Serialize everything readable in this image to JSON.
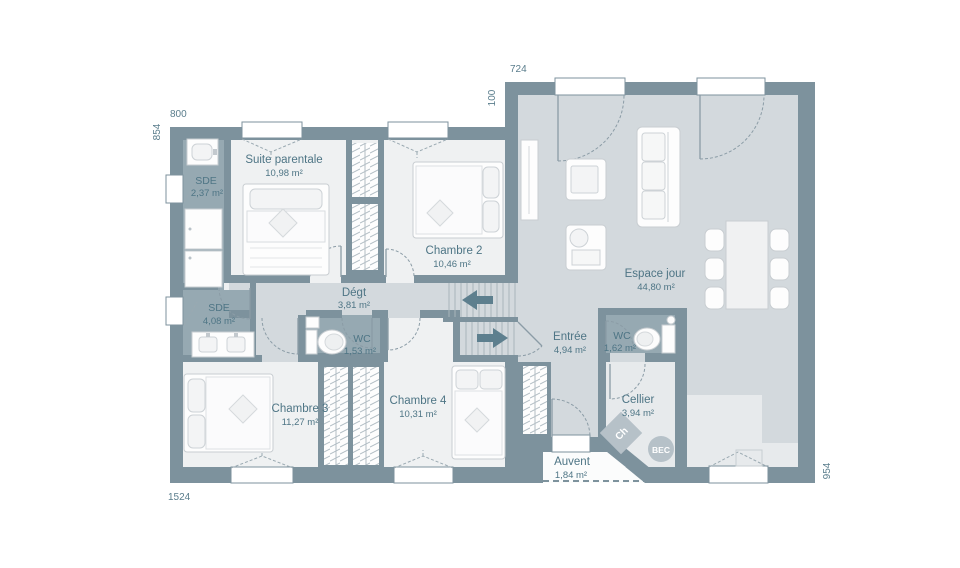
{
  "plan": {
    "dimensions": {
      "top_left": "800",
      "left_side": "854",
      "top_right": "724",
      "offset": "100",
      "bottom_left": "1524",
      "right_side": "954"
    },
    "rooms": {
      "suite": {
        "name": "Suite parentale",
        "area": "10,98 m²"
      },
      "sde1": {
        "name": "SDE",
        "area": "2,37 m²"
      },
      "chambre2": {
        "name": "Chambre 2",
        "area": "10,46 m²"
      },
      "degt": {
        "name": "Dégt",
        "area": "3,81 m²"
      },
      "sde2": {
        "name": "SDE",
        "area": "4,08 m²"
      },
      "wc1": {
        "name": "WC",
        "area": "1,53 m²"
      },
      "chambre3": {
        "name": "Chambre 3",
        "area": "11,27 m²"
      },
      "chambre4": {
        "name": "Chambre 4",
        "area": "10,31 m²"
      },
      "entree": {
        "name": "Entrée",
        "area": "4,94 m²"
      },
      "wc2": {
        "name": "WC",
        "area": "1,62 m²"
      },
      "espace": {
        "name": "Espace jour",
        "area": "44,80 m²"
      },
      "cellier": {
        "name": "Cellier",
        "area": "3,94 m²"
      },
      "auvent": {
        "name": "Auvent",
        "area": "1,84 m²"
      }
    },
    "equipment": {
      "water_heater": "Ch",
      "bec": "BEC"
    },
    "colors": {
      "wall": "#7d929d",
      "floor_bedroom": "#eff1f2",
      "floor_wet": "#96a9b2",
      "floor_circulation": "#d3d9dd",
      "floor_annex": "#e7eaec",
      "label_text": "#4e7585"
    }
  }
}
